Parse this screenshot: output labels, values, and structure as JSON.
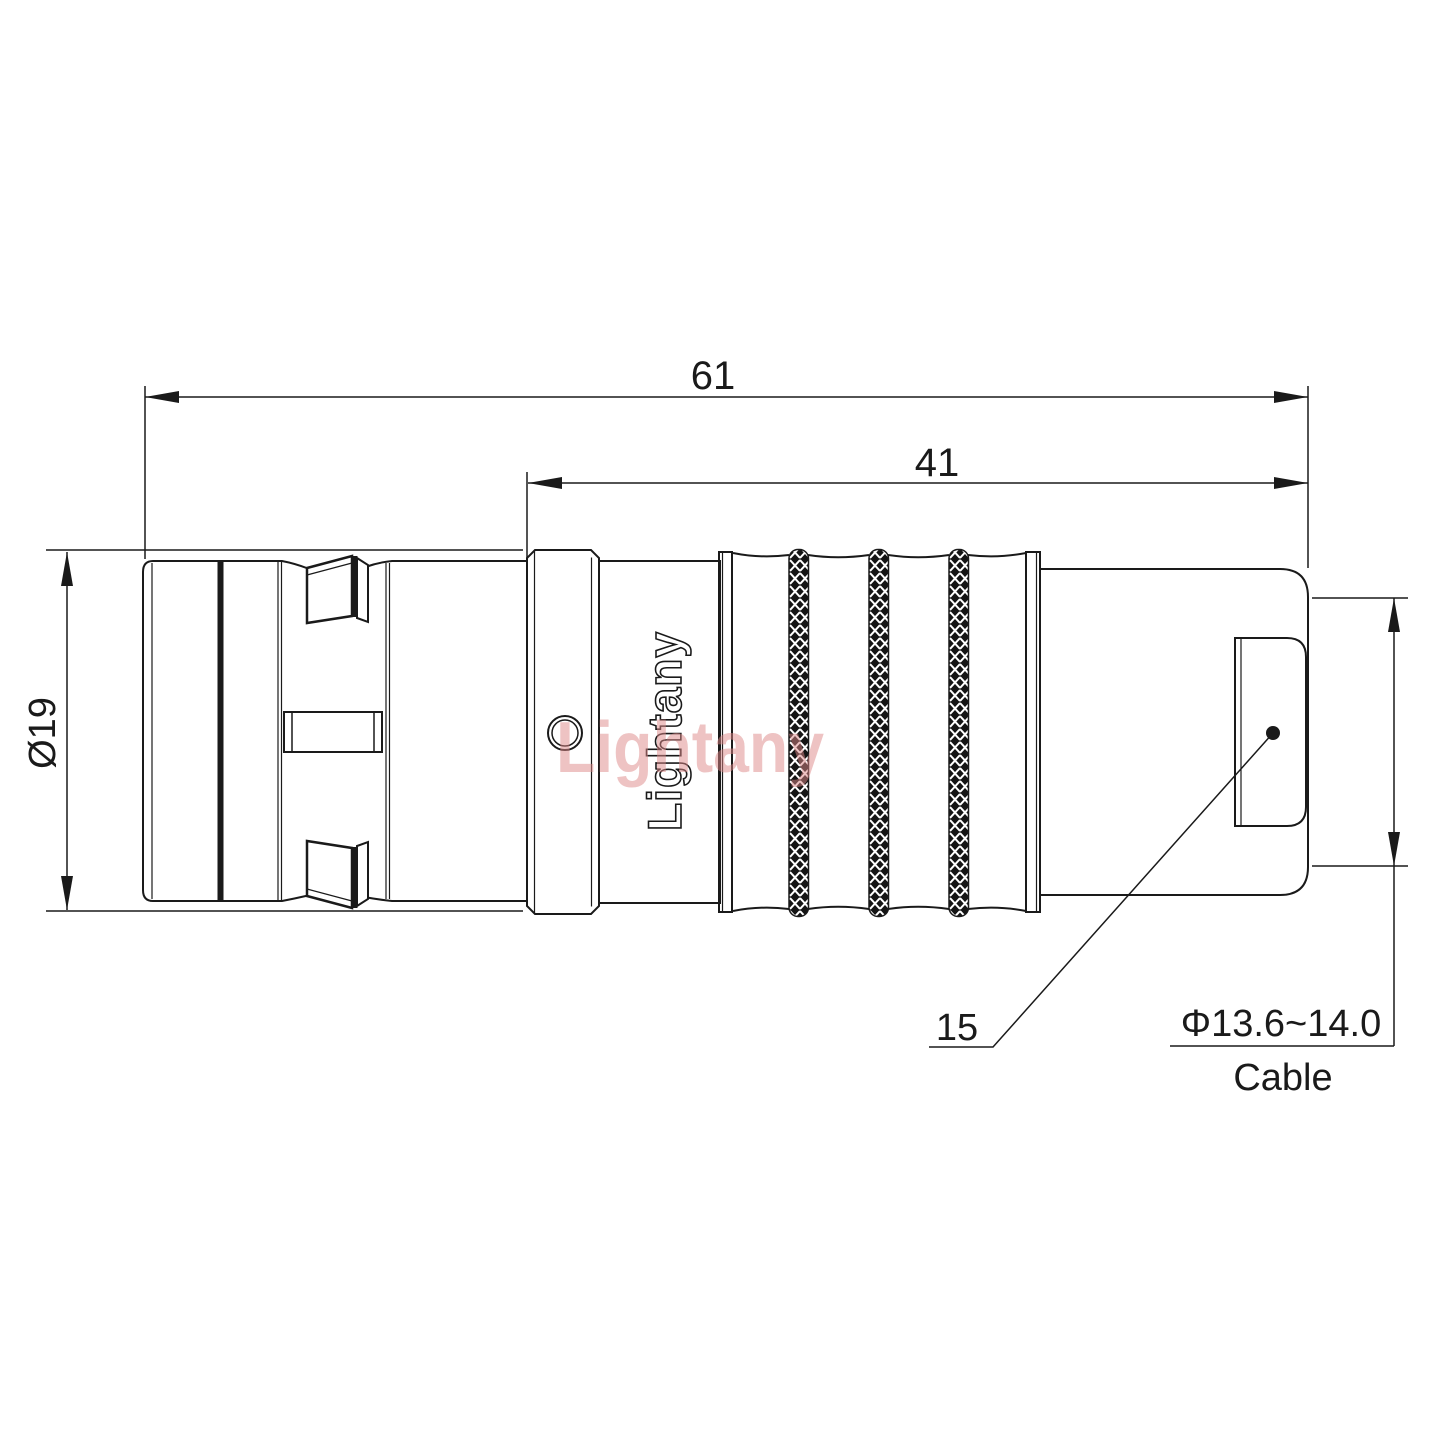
{
  "drawing": {
    "brand_engraved": "Lightany",
    "brand_watermark": "Lightany",
    "dims": {
      "overall_length": "61",
      "rear_length": "41",
      "body_diameter": "Ø19",
      "boot_length": "15",
      "cable_spec": "Φ13.6~14.0",
      "cable_label": "Cable"
    },
    "colors": {
      "line": "#1a1a1a",
      "watermark": "#dd8888",
      "background": "#ffffff"
    }
  }
}
